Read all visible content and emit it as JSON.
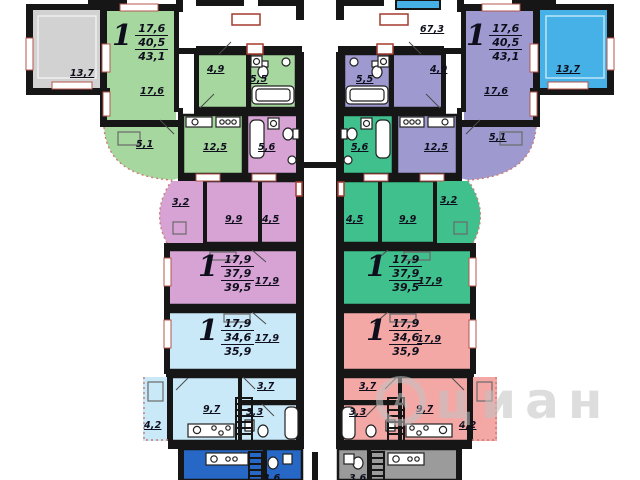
{
  "watermark": {
    "logo_letter": "А",
    "text": "циан"
  },
  "lobby_area": "67,3",
  "balcony_left": "13,7",
  "balcony_right": "13,7",
  "partial_bottom": {
    "left_room": "3,6",
    "right_room": "3,6"
  },
  "apartments": {
    "tl": {
      "rooms_count": "1",
      "living_area": "17,6",
      "area": "40,5",
      "total_area": "43,1",
      "labels": {
        "living": "17,6",
        "hall": "4,9",
        "bath": "5,5",
        "loggia": "5,1",
        "kitchen": "12,5"
      }
    },
    "tr": {
      "rooms_count": "1",
      "living_area": "17,6",
      "area": "40,5",
      "total_area": "43,1",
      "labels": {
        "living": "17,6",
        "hall": "4,9",
        "bath": "5,5",
        "loggia": "5,1",
        "kitchen": "12,5"
      }
    },
    "ml": {
      "rooms_count": "1",
      "living_area": "17,9",
      "area": "37,9",
      "total_area": "39,5",
      "labels": {
        "living": "17,9",
        "bath": "5,6",
        "loggia": "3,2",
        "kitchen": "9,9",
        "hall": "4,5"
      }
    },
    "mr": {
      "rooms_count": "1",
      "living_area": "17,9",
      "area": "37,9",
      "total_area": "39,5",
      "labels": {
        "living": "17,9",
        "bath": "5,6",
        "loggia": "3,2",
        "kitchen": "9,9",
        "hall": "4,5"
      }
    },
    "bl": {
      "rooms_count": "1",
      "living_area": "17,9",
      "area": "34,6",
      "total_area": "35,9",
      "labels": {
        "living": "17,9",
        "loggia": "4,2",
        "kitchen": "9,7",
        "hall": "3,7",
        "bath": "3,3"
      }
    },
    "br": {
      "rooms_count": "1",
      "living_area": "17,9",
      "area": "34,6",
      "total_area": "35,9",
      "labels": {
        "living": "17,9",
        "loggia": "4,2",
        "kitchen": "9,7",
        "hall": "3,7",
        "bath": "3,3"
      }
    }
  },
  "colors": {
    "wall": "#161616",
    "balcony_gray": "#d2d2d2",
    "apt_green_light": "#a6d79f",
    "apt_purple": "#9e9ad0",
    "balcony_blue": "#46b1e6",
    "apt_pink": "#d6a3d4",
    "apt_green": "#3fc08d",
    "apt_blue_light": "#c9e9f8",
    "apt_salmon": "#f4a8a6",
    "apt_blue_dark": "#2767c5",
    "apt_gray": "#9b9b9b",
    "accent_red": "#a33b2e"
  }
}
